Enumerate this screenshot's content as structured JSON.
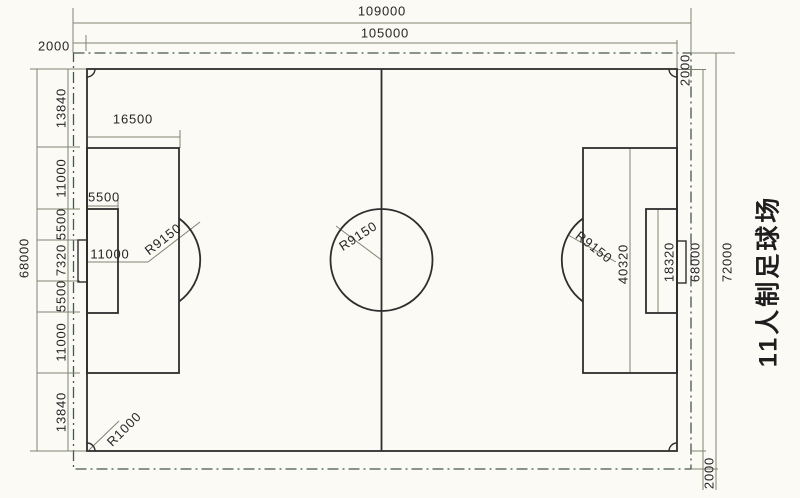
{
  "drawing": {
    "title": "11人制足球场",
    "type": "football-pitch-dimension-drawing",
    "colors": {
      "background": "#fbfaf5",
      "field_line": "#2e2e2e",
      "dimension_line": "#7f8470",
      "boundary_line": "#45584b",
      "text": "#262626"
    },
    "dimensions": {
      "overall_length": "109000",
      "field_length": "105000",
      "overall_width": "72000",
      "field_width": "68000",
      "margin": "2000",
      "penalty_area_depth": "16500",
      "penalty_area_width": "40320",
      "goal_area_depth": "5500",
      "goal_area_width": "18320",
      "goal_mouth_width": "7320",
      "penalty_mark_distance": "11000",
      "center_circle_radius": "R9150",
      "penalty_arc_radius": "R9150",
      "corner_arc_radius": "R1000",
      "left_edge_segments": [
        "13840",
        "11000",
        "5500",
        "7320",
        "5500",
        "11000",
        "13840"
      ]
    },
    "labels": [
      {
        "name": "dim-109000",
        "text": "109000"
      },
      {
        "name": "dim-105000",
        "text": "105000"
      },
      {
        "name": "dim-2000-top-left",
        "text": "2000"
      },
      {
        "name": "dim-2000-top-right",
        "text": "2000"
      },
      {
        "name": "dim-68000-left",
        "text": "68000"
      },
      {
        "name": "seg-13840-top",
        "text": "13840"
      },
      {
        "name": "seg-11000-top",
        "text": "11000"
      },
      {
        "name": "seg-5500-top",
        "text": "5500"
      },
      {
        "name": "seg-7320",
        "text": "7320"
      },
      {
        "name": "seg-5500-bottom",
        "text": "5500"
      },
      {
        "name": "seg-11000-bottom",
        "text": "11000"
      },
      {
        "name": "seg-13840-bottom",
        "text": "13840"
      },
      {
        "name": "dim-16500",
        "text": "16500"
      },
      {
        "name": "dim-5500-goal-area",
        "text": "5500"
      },
      {
        "name": "dim-11000-penalty",
        "text": "11000"
      },
      {
        "name": "dim-r9150-left",
        "text": "R9150"
      },
      {
        "name": "dim-r9150-center",
        "text": "R9150"
      },
      {
        "name": "dim-r9150-right",
        "text": "R9150"
      },
      {
        "name": "dim-40320",
        "text": "40320"
      },
      {
        "name": "dim-18320",
        "text": "18320"
      },
      {
        "name": "dim-r1000",
        "text": "R1000"
      },
      {
        "name": "dim-68000-right",
        "text": "68000"
      },
      {
        "name": "dim-72000",
        "text": "72000"
      },
      {
        "name": "dim-2000-bottom-right",
        "text": "2000"
      }
    ]
  }
}
